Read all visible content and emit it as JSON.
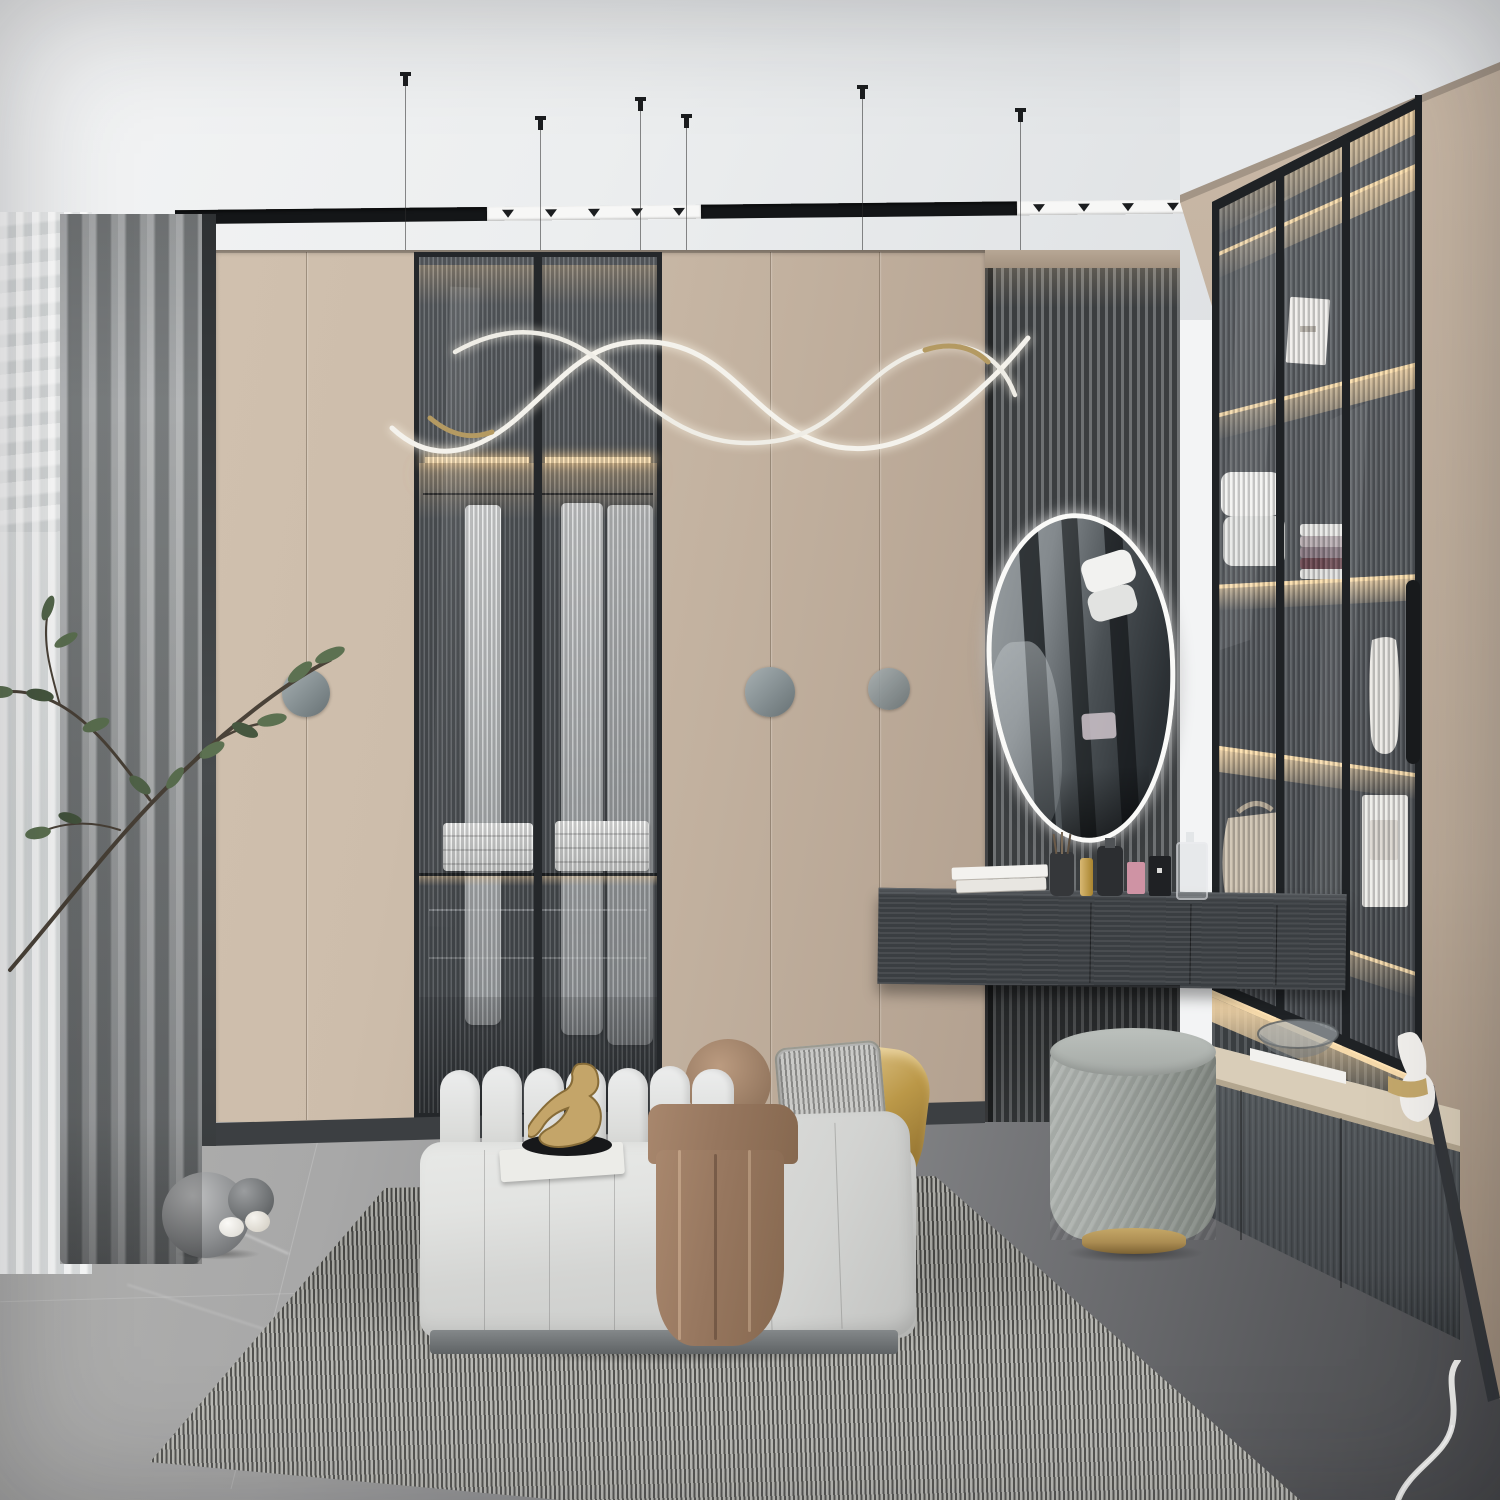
{
  "scene": {
    "type": "interior-3d-render",
    "room": "modern walk-in closet and dressing room",
    "style": "minimal luxury, beige and grey palette",
    "objects": [
      {
        "name": "ceiling-track-light",
        "desc": "recessed black linear track with white spotlight segments"
      },
      {
        "name": "ribbon-chandelier",
        "desc": "suspended curved LED ribbon light on thin wires"
      },
      {
        "name": "window-sheer-curtain",
        "desc": "white sheer curtain at left window"
      },
      {
        "name": "grey-curtain",
        "desc": "textured grey drape"
      },
      {
        "name": "plant-branch",
        "desc": "green branch in front of curtains"
      },
      {
        "name": "wardrobe-wall",
        "desc": "beige panel wardrobe with round grey handles"
      },
      {
        "name": "glass-wardrobe",
        "desc": "fluted glass double doors, lit interior with hanging clothes and towels"
      },
      {
        "name": "slat-feature-wall",
        "desc": "dark wood slat panel behind mirror"
      },
      {
        "name": "vanity-mirror",
        "desc": "organic egg-shaped mirror with white LED rim"
      },
      {
        "name": "vanity-desk",
        "desc": "floating dark wood makeup desk with perfumes, books, cosmetics"
      },
      {
        "name": "display-cabinet-wall",
        "desc": "tall fluted-glass display cabinets with LED shelves, towels, vase, handbag"
      },
      {
        "name": "lower-counter",
        "desc": "beige stone counter on dark base cabinets with glass bowl and gold-white vase"
      },
      {
        "name": "upholstered-bench",
        "desc": "channel-tufted light grey bench with sculpture, brown throw, pillows"
      },
      {
        "name": "pillows",
        "desc": "round brown, grey striped and metallic gold pillows"
      },
      {
        "name": "cylinder-pouf",
        "desc": "grey velvet pouf with brass base"
      },
      {
        "name": "striped-rug",
        "desc": "fine black-white striped area rug"
      },
      {
        "name": "marble-floor",
        "desc": "grey marble tiles, darker toward right, white veins"
      },
      {
        "name": "decor-spheres",
        "desc": "grey marble balls and small white eggs on floor"
      }
    ],
    "counts": {
      "pendant_wires": 6,
      "track_spot_segments": 2,
      "wardrobe_round_handles": 3,
      "cabinet_columns": 3,
      "cabinet_shelves": 5,
      "bench_back_capsules": 7
    }
  },
  "palette": {
    "ceiling1": "#f3f4f5",
    "ceiling2": "#dadde0",
    "trackDark": "#141618",
    "trackLight": "#f7f7f6",
    "beige1": "#cdbdab",
    "beige2": "#c2b19f",
    "beige3": "#b3a190",
    "beigeDark": "#a08d7b",
    "glassDark": "#54585c",
    "frameDark": "#24272a",
    "ledWarm": "#ffe3b4",
    "slat1": "#6e7173",
    "slat2": "#3b3e40",
    "curtain1": "#939697",
    "sheer1": "#f2f3f3",
    "sheer2": "#dfe2e2",
    "mirrorRim": "#fafaf8",
    "deskDark": "#3f4347",
    "counterTop": "#d9cdb8",
    "counterBase": "#4b5054",
    "floor1": "#a8a8a8",
    "floor2": "#8d8e90",
    "floor3": "#5a5b5e",
    "floor4": "#47484b",
    "rugBase": "#90908c",
    "bench1": "#e2e3e1",
    "bench2": "#cbccca",
    "benchPlinth": "#84888a",
    "blanket1": "#a8876d",
    "blanket2": "#86684f",
    "pillowGold1": "#dcc287",
    "pillowGold2": "#8f6f2e",
    "pillowStripe": "#b5b5b3",
    "pouf1": "#a9aeaa",
    "pouf2": "#7f857f",
    "brass": "#ab8c52",
    "green1": "#5c7151",
    "branch": "#4a4238",
    "gold": "#c3a76b",
    "ribbon": "#f4f2ec"
  }
}
